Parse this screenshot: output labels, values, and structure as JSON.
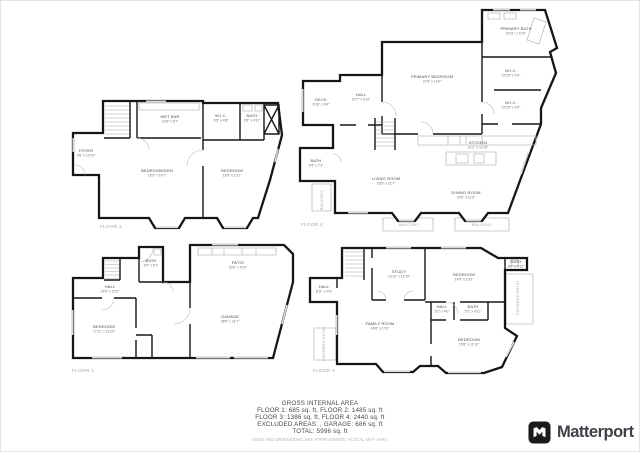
{
  "colors": {
    "wall": "#161616",
    "fixture": "#bdbdbd",
    "room_label": "#4a4a4a",
    "muted_label": "#a6a6a6",
    "summary_text": "#45454f",
    "disclaimer_text": "#b3b3b3",
    "brand_text": "#3e4147"
  },
  "area_summary": {
    "title": "GROSS INTERNAL AREA",
    "line1": "FLOOR 1: 685 sq. ft, FLOOR 2: 1485 sq. ft",
    "line2": "FLOOR 3: 1386 sq. ft, FLOOR 4: 2440 sq. ft",
    "line3": "EXCLUDED AREAS: , GARAGE: 686 sq. ft",
    "total": "TOTAL: 5996 sq. ft",
    "disclaimer": "SIZES AND DIMENSIONS ARE APPROXIMATE, ACTUAL MAY VARY."
  },
  "brand": {
    "name": "Matterport"
  },
  "floor_plans": [
    {
      "id": "floor2",
      "caption": "FLOOR 2",
      "rooms": [
        {
          "name": "WET BAR",
          "dims": "10'8\" x 6'7\"",
          "x": 108,
          "y": 30
        },
        {
          "name": "W.I.C.",
          "dims": "6'5\" x 4'8\"",
          "x": 159,
          "y": 29
        },
        {
          "name": "BATH",
          "dims": "9'5\" x 4'11\"",
          "x": 190,
          "y": 29
        },
        {
          "name": "FOYER",
          "dims": "9'6\" x 10'10\"",
          "x": 24,
          "y": 64
        },
        {
          "name": "BEDROOM/DEN",
          "dims": "16'0\" x 14'7\"",
          "x": 95,
          "y": 84
        },
        {
          "name": "BEDROOM",
          "dims": "16'0\" x 13'2\"",
          "x": 170,
          "y": 84
        }
      ]
    },
    {
      "id": "floor4",
      "caption": "FLOOR 4",
      "rooms": [
        {
          "name": "PRIMARY BATH",
          "dims": "15'11\" x 10'9\"",
          "x": 218,
          "y": 26
        },
        {
          "name": "PRIMARY BEDROOM",
          "dims": "21'8\" x 14'0\"",
          "x": 134,
          "y": 74
        },
        {
          "name": "W.I.C.",
          "dims": "10'10\" x 5'9\"",
          "x": 213,
          "y": 68
        },
        {
          "name": "W.I.C.",
          "dims": "10'10\" x 6'5\"",
          "x": 213,
          "y": 100
        },
        {
          "name": "DECK",
          "dims": "8'10\" x 6'4\"",
          "x": 23,
          "y": 97
        },
        {
          "name": "HALL",
          "dims": "10'7\" x 4'10\"",
          "x": 63,
          "y": 92
        },
        {
          "name": "BATH",
          "dims": "8'4\" x 7'3\"",
          "x": 18,
          "y": 158
        },
        {
          "name": "LIVING ROOM",
          "dims": "23'5\" x 21'7\"",
          "x": 88,
          "y": 176
        },
        {
          "name": "KITCHEN",
          "dims": "21'2\" x 11'10\"",
          "x": 180,
          "y": 140
        },
        {
          "name": "DINING ROOM",
          "dims": "20'5\" x 11'6\"",
          "x": 168,
          "y": 190
        },
        {
          "name": "BALCONY",
          "x": 25,
          "y": 196,
          "muted": true,
          "rotate": true
        },
        {
          "name": "BALCONY",
          "x": 111,
          "y": 222,
          "muted": true
        },
        {
          "name": "BALCONY",
          "x": 184,
          "y": 222,
          "muted": true
        }
      ]
    },
    {
      "id": "floor1",
      "caption": "FLOOR 1",
      "rooms": [
        {
          "name": "BATH",
          "dims": "8'9\" x 5'1\"",
          "x": 89,
          "y": 22
        },
        {
          "name": "PATIO",
          "dims": "30'6\" x 9'10\"",
          "x": 176,
          "y": 24
        },
        {
          "name": "HALL",
          "dims": "14'8\" x 3'10\"",
          "x": 48,
          "y": 48
        },
        {
          "name": "BEDROOM",
          "dims": "17'11\" x 13'10\"",
          "x": 42,
          "y": 88
        },
        {
          "name": "GARAGE",
          "dims": "28'6\" x 21'7\"",
          "x": 168,
          "y": 78
        }
      ]
    },
    {
      "id": "floor3",
      "caption": "FLOOR 3",
      "rooms": [
        {
          "name": "STUDY",
          "dims": "13'10\" x 12'10\"",
          "x": 93,
          "y": 33
        },
        {
          "name": "BEDROOM",
          "dims": "14'9\" x 13'5\"",
          "x": 158,
          "y": 36
        },
        {
          "name": "BATH",
          "dims": "8'0\" x 4'11\"",
          "x": 210,
          "y": 23
        },
        {
          "name": "HALL",
          "dims": "8'11\" x 4'9\"",
          "x": 18,
          "y": 48
        },
        {
          "name": "FAMILY ROOM",
          "dims": "24'8\" x 17'6\"",
          "x": 74,
          "y": 85
        },
        {
          "name": "HALL",
          "dims": "5'2\" x 4'0\"",
          "x": 136,
          "y": 68
        },
        {
          "name": "BATH",
          "dims": "5'2\" x 4'11\"",
          "x": 167,
          "y": 68
        },
        {
          "name": "BEDROOM",
          "dims": "15'8\" x 11'10\"",
          "x": 163,
          "y": 101
        },
        {
          "name": "COVERED PATIO",
          "x": 213,
          "y": 58,
          "muted": true,
          "rotate": true
        },
        {
          "name": "COVERED PATIO",
          "x": 19,
          "y": 104,
          "muted": true,
          "rotate": true
        }
      ]
    }
  ]
}
